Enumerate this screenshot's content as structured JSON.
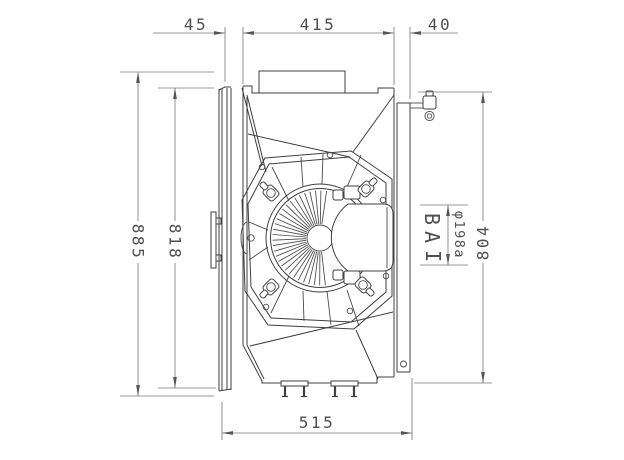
{
  "page": {
    "background": "#ffffff"
  },
  "colors": {
    "geometry_line": "#3f3f3f",
    "dimension_line": "#767676",
    "dimension_text": "#4f4f4f"
  },
  "dimensions": {
    "top_left_offset": "45",
    "top_center_width": "415",
    "top_right_offset": "40",
    "overall_height": "885",
    "core_height": "818",
    "shroud_height": "804",
    "bottom_width": "515",
    "motor_diameter": "φ198a",
    "section_label": "BA",
    "section_label_mark": "I"
  }
}
